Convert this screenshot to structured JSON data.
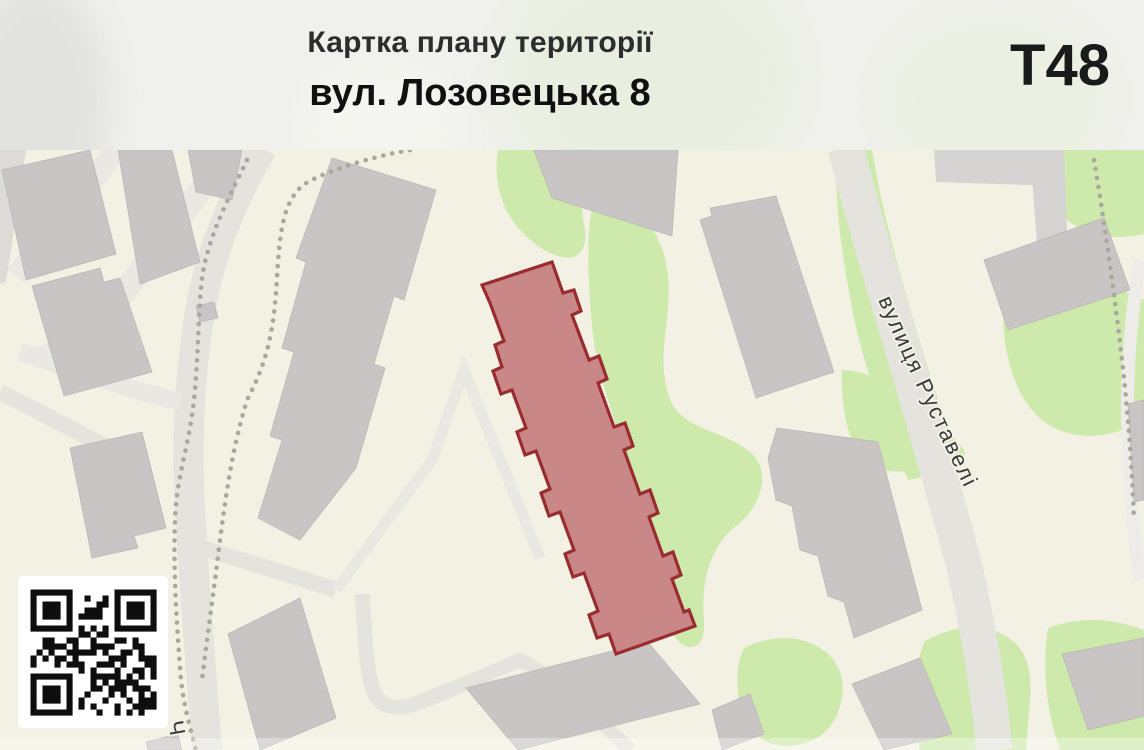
{
  "header": {
    "title": "Картка плану території",
    "subtitle": "вул. Лозовецька 8",
    "sheet_code": "T48"
  },
  "map": {
    "street_label_primary": "вулиця Руставелі",
    "street_label_partial": "Ч",
    "colors": {
      "background": "#f2f1e4",
      "road": "#e4e3dd",
      "building": "#c8c5c4",
      "green_area": "#cde9ab",
      "tree_dots": "#a9a89c",
      "highlight_fill": "#c98788",
      "highlight_stroke": "#9a2b2e"
    }
  }
}
